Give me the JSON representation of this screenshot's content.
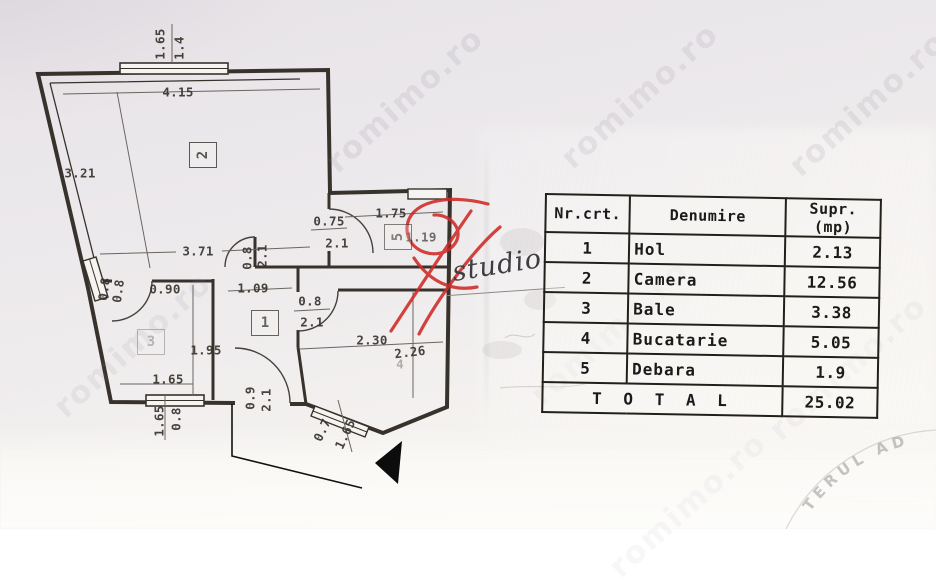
{
  "colors": {
    "wall_line": "#38322d",
    "dim_line": "#6b655f",
    "logo_red": "#ce2a25",
    "paper_top": "#e7e3e7",
    "paper_bottom": "#faf9f6",
    "watermark_gray": "rgba(132,127,144,0.36)",
    "stamp_gray": "rgba(152,148,150,0.55)"
  },
  "watermark": {
    "text": "romimo.ro",
    "positions": [
      {
        "x": 405,
        "y": 100,
        "o": 0.4
      },
      {
        "x": 640,
        "y": 96,
        "o": 0.38
      },
      {
        "x": 868,
        "y": 104,
        "o": 0.38
      },
      {
        "x": 133,
        "y": 345,
        "o": 0.3
      },
      {
        "x": 610,
        "y": 333,
        "o": 0.2
      },
      {
        "x": 848,
        "y": 368,
        "o": 0.2
      },
      {
        "x": 688,
        "y": 505,
        "o": 0.16
      }
    ]
  },
  "logo": {
    "studio_text": "studio"
  },
  "stamp": {
    "arc_text": "TERUL AD"
  },
  "table": {
    "headers": [
      "Nr.crt.",
      "Denumire",
      "Supr.(mp)"
    ],
    "rows": [
      {
        "nr": "1",
        "name": "Hol",
        "area": "2.13"
      },
      {
        "nr": "2",
        "name": "Camera",
        "area": "12.56"
      },
      {
        "nr": "3",
        "name": "Bale",
        "area": "3.38"
      },
      {
        "nr": "4",
        "name": "Bucatarie",
        "area": "5.05"
      },
      {
        "nr": "5",
        "name": "Debara",
        "area": "1.9"
      }
    ],
    "total_label": "T O T A L",
    "total_value": "25.02"
  },
  "plan": {
    "rooms": [
      {
        "n": "2",
        "x": 202,
        "y": 154,
        "r": -90,
        "o": 0.8
      },
      {
        "n": "5",
        "x": 397,
        "y": 236,
        "r": -90,
        "o": 0.6
      },
      {
        "n": "1",
        "x": 264,
        "y": 322,
        "r": 0,
        "o": 0.75
      },
      {
        "n": "3",
        "x": 150,
        "y": 341,
        "r": 0,
        "o": 0.3
      }
    ],
    "dimensions": [
      {
        "t": "1.65",
        "x": 160,
        "y": 44,
        "r": -90
      },
      {
        "t": "1.4",
        "x": 179,
        "y": 48,
        "r": -90
      },
      {
        "t": "4.15",
        "x": 178,
        "y": 92,
        "r": 0
      },
      {
        "t": "3.21",
        "x": 80,
        "y": 173,
        "r": 0
      },
      {
        "t": "3.71",
        "x": 198,
        "y": 251,
        "r": 0
      },
      {
        "t": "1.75",
        "x": 391,
        "y": 213,
        "r": 0
      },
      {
        "t": "0.75",
        "x": 329,
        "y": 221,
        "r": 0
      },
      {
        "t": "2.1",
        "x": 337,
        "y": 243,
        "r": 0
      },
      {
        "t": "1.19",
        "x": 421,
        "y": 237,
        "r": 0,
        "o": 0.7
      },
      {
        "t": "0.8",
        "x": 247,
        "y": 258,
        "r": -90
      },
      {
        "t": "2.1",
        "x": 262,
        "y": 256,
        "r": -90
      },
      {
        "t": "1.09",
        "x": 253,
        "y": 288,
        "r": 0
      },
      {
        "t": "0.90",
        "x": 165,
        "y": 289,
        "r": 0
      },
      {
        "t": "0.8",
        "x": 104,
        "y": 289,
        "r": -82
      },
      {
        "t": "0.8",
        "x": 118,
        "y": 291,
        "r": -82
      },
      {
        "t": "0.8",
        "x": 310,
        "y": 301,
        "r": 0
      },
      {
        "t": "2.1",
        "x": 312,
        "y": 322,
        "r": 0
      },
      {
        "t": "1.95",
        "x": 206,
        "y": 350,
        "r": 0
      },
      {
        "t": "1.65",
        "x": 168,
        "y": 379,
        "r": 0
      },
      {
        "t": "1.65",
        "x": 159,
        "y": 421,
        "r": -90
      },
      {
        "t": "0.8",
        "x": 176,
        "y": 419,
        "r": -90
      },
      {
        "t": "0.9",
        "x": 250,
        "y": 398,
        "r": -90
      },
      {
        "t": "2.1",
        "x": 266,
        "y": 400,
        "r": -90
      },
      {
        "t": "2.30",
        "x": 372,
        "y": 340,
        "r": 0
      },
      {
        "t": "2.26",
        "x": 410,
        "y": 352,
        "r": -7
      },
      {
        "t": "4",
        "x": 400,
        "y": 364,
        "r": 0,
        "o": 0.35
      },
      {
        "t": "0.7",
        "x": 322,
        "y": 430,
        "r": -65
      },
      {
        "t": "1.65",
        "x": 345,
        "y": 434,
        "r": -65
      }
    ]
  }
}
